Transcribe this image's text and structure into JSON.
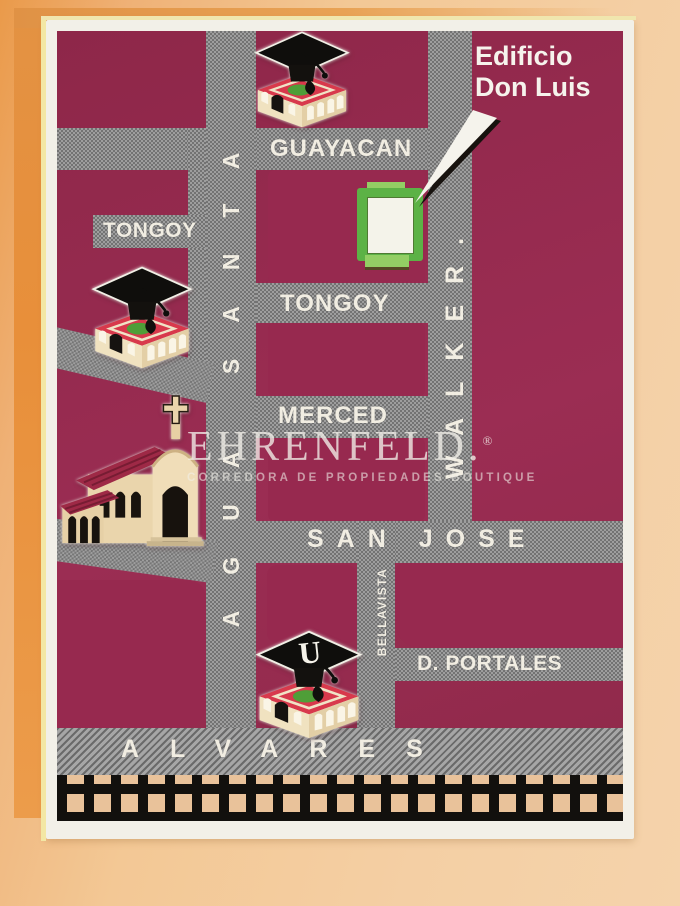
{
  "brand": {
    "name": "EHRENFELD.",
    "registered": "®",
    "tagline": "CORREDORA DE PROPIEDADES BOUTIQUE"
  },
  "callout": {
    "line1": "Edificio",
    "line2": "Don Luis"
  },
  "streets": {
    "guayacan": "GUAYACAN",
    "tongoy_west": "TONGOY",
    "tongoy": "TONGOY",
    "merced": "MERCED",
    "san_jose": "SAN JOSE",
    "d_portales": "D. PORTALES",
    "alvares": "ALVARES",
    "agua_santa": "AGUA SANTA",
    "walker": "WALKER.",
    "bellavista": "BELLAVISTA"
  },
  "landmarks": {
    "university_letter": "U"
  },
  "colors": {
    "block_maroon": "#97294F",
    "street_gray": "#8A8A8A",
    "marker_green": "#5CB246",
    "card_white": "#F2F0E8",
    "page_orange": "#E88F3A",
    "rail_cream": "#E9C29A",
    "label_text": "#F1EDE2"
  }
}
